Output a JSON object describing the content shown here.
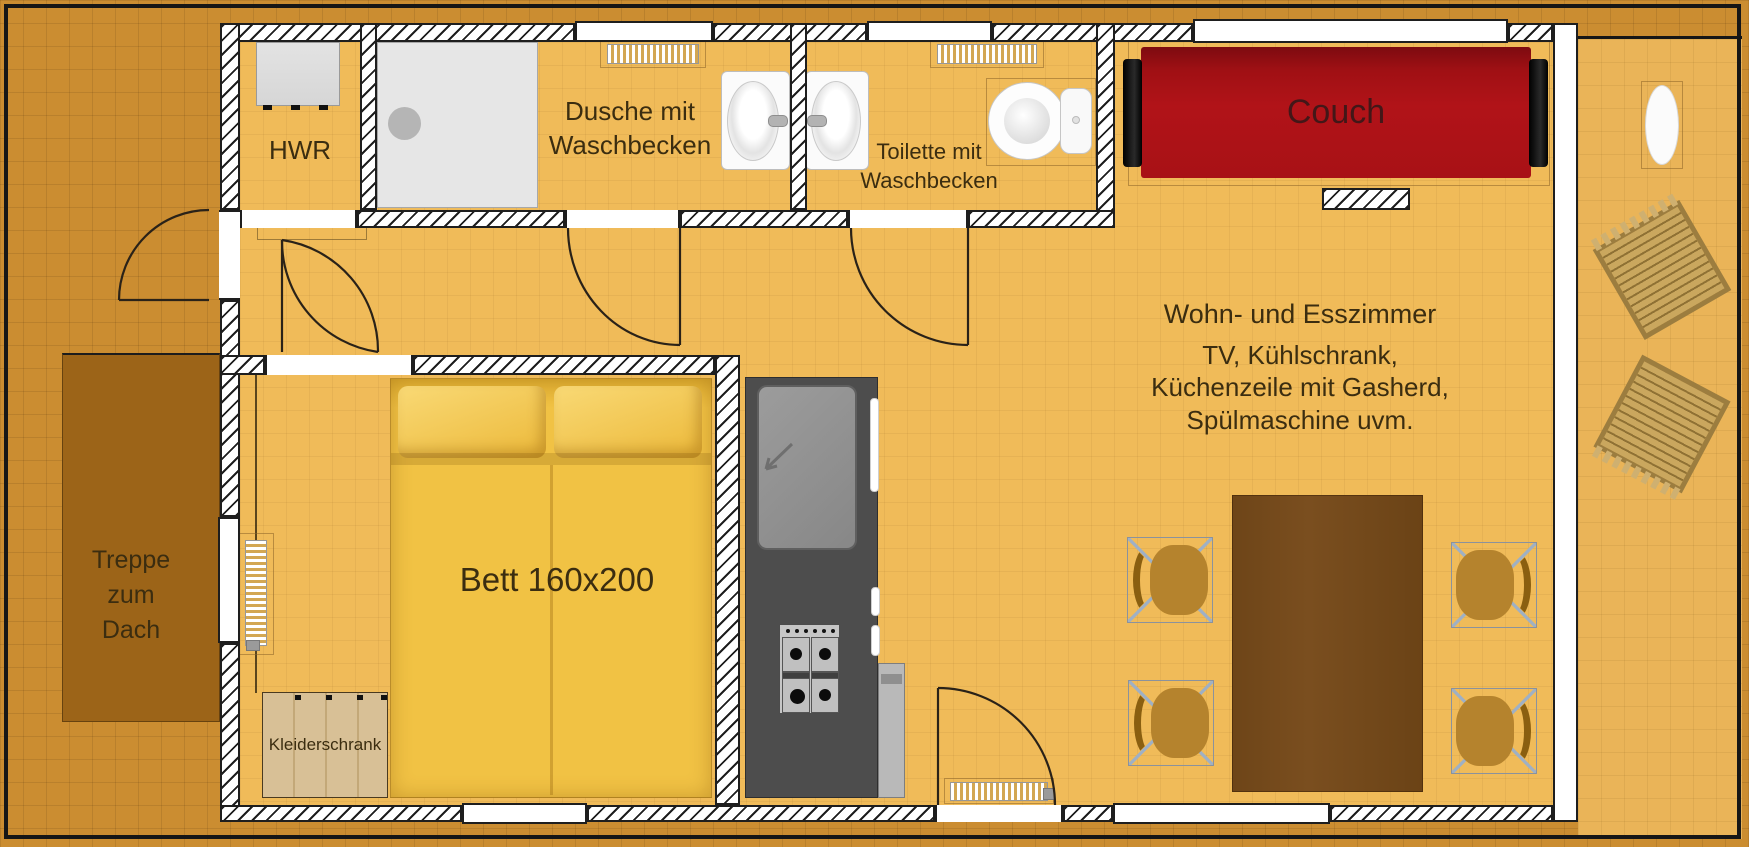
{
  "plan": {
    "rooms": {
      "hwr": {
        "label": "HWR"
      },
      "shower": {
        "line1": "Dusche mit",
        "line2": "Waschbecken"
      },
      "toilet": {
        "line1": "Toilette mit",
        "line2": "Waschbecken"
      },
      "living": {
        "title": "Wohn- und Esszimmer",
        "line1": "TV, Kühlschrank,",
        "line2": "Küchenzeile mit Gasherd,",
        "line3": "Spülmaschine uvm."
      },
      "bedroom": {
        "bed_label": "Bett 160x200",
        "wardrobe_label": "Kleiderschrank"
      },
      "stairs": {
        "line1": "Treppe",
        "line2": "zum",
        "line3": "Dach"
      },
      "couch_label": "Couch"
    },
    "colors": {
      "outside": "#CB8D31",
      "terrace": "#EAB458",
      "floor": "#F0BB59",
      "wall": "#1E1E1E",
      "couch": "#B11318",
      "bed": "#F1C244",
      "table": "#7A4E1F",
      "chair": "#B5832D",
      "counter": "#4D4D4D",
      "stairs": "#9C6418",
      "wardrobe": "#D8C096",
      "label": "#3B2D10"
    }
  }
}
